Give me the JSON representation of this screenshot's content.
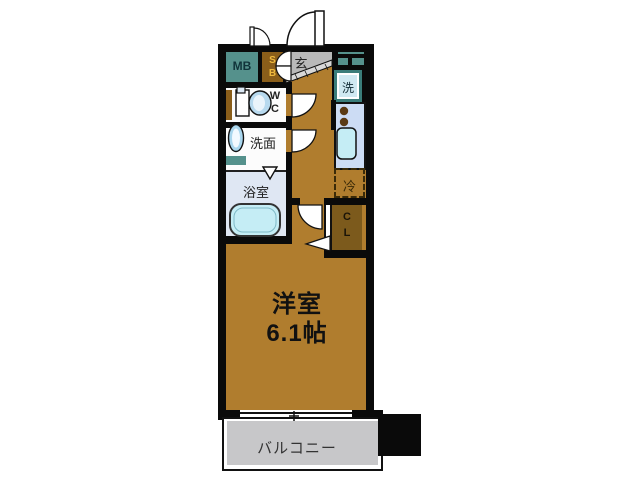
{
  "title": "floor-plan",
  "colors": {
    "wall": "#0a0a0a",
    "room_brown": "#b07d2e",
    "closet_brown": "#7c5a1c",
    "shoebox_brown": "#8a5e1a",
    "teal_accent": "#55918c",
    "entrance_gray": "#b9b9b9",
    "balcony_gray": "#c7c7c9",
    "kitchen_blue": "#ccdcf4",
    "fixture_cyan": "#c5edf5",
    "shoebox_text_yellow": "#eeb93e"
  },
  "rooms": {
    "main_room": {
      "name": "洋室",
      "size": "6.1帖"
    },
    "balcony": {
      "label": "バルコニー"
    },
    "entrance": {
      "label": "玄"
    },
    "meter_box": {
      "label": "MB"
    },
    "shoe_box": {
      "lines": [
        "S",
        "B"
      ]
    },
    "washer": {
      "label": "洗"
    },
    "toilet": {
      "lines": [
        "W",
        "C"
      ]
    },
    "washroom": {
      "label": "洗面"
    },
    "bathroom": {
      "label": "浴室"
    },
    "refrigerator": {
      "label": "冷"
    },
    "closet": {
      "lines": [
        "C",
        "L"
      ]
    }
  }
}
